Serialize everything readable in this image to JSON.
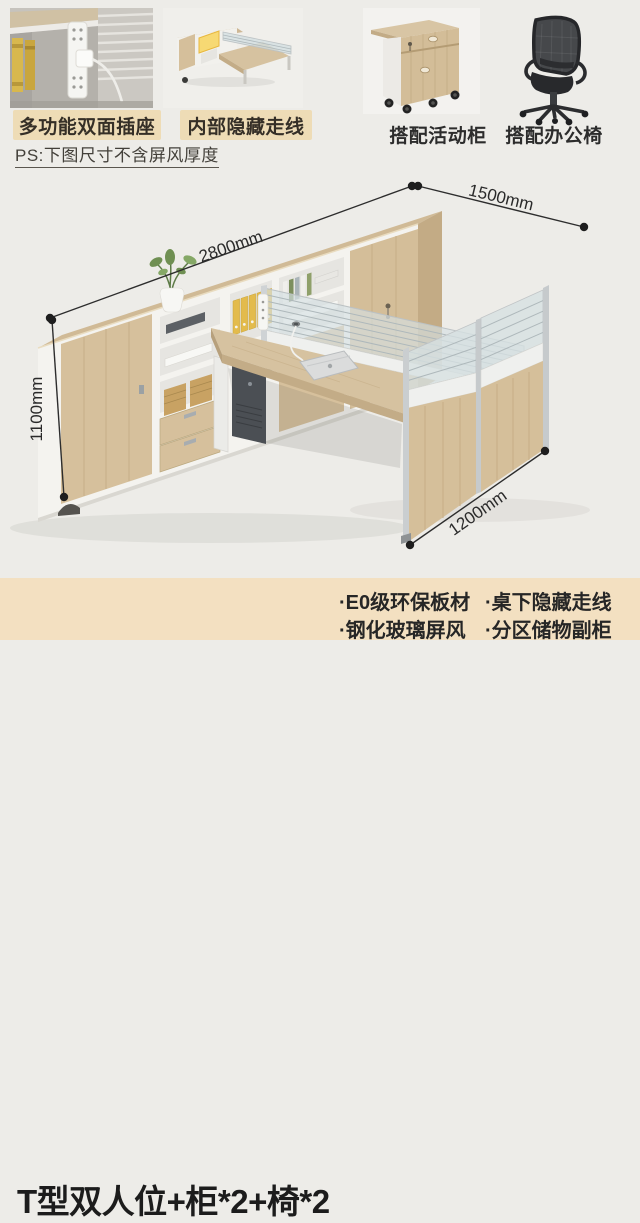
{
  "features": [
    {
      "label": "多功能双面插座"
    },
    {
      "label": "内部隐藏走线"
    },
    {
      "label": "搭配活动柜"
    },
    {
      "label": "搭配办公椅"
    }
  ],
  "note": "PS:下图尺寸不含屏风厚度",
  "dimensions": {
    "cabinet_length": "2800mm",
    "desk_length": "1500mm",
    "cabinet_height": "1100mm",
    "end_width": "1200mm"
  },
  "banner": {
    "title": "T型双人位+柜*2+椅*2",
    "bullets": [
      "·E0级环保板材",
      "·桌下隐藏走线",
      "·钢化玻璃屏风",
      "·分区储物副柜"
    ]
  },
  "colors": {
    "page_bg": "#edece8",
    "banner_bg": "#f3e0c1",
    "chip_bg": "#eedcb6",
    "wood": "#d5bf9b",
    "white_panel": "#f3f2ee",
    "binder_yellow": "#e3bb4c",
    "dimension_line": "#2d2d2d"
  }
}
